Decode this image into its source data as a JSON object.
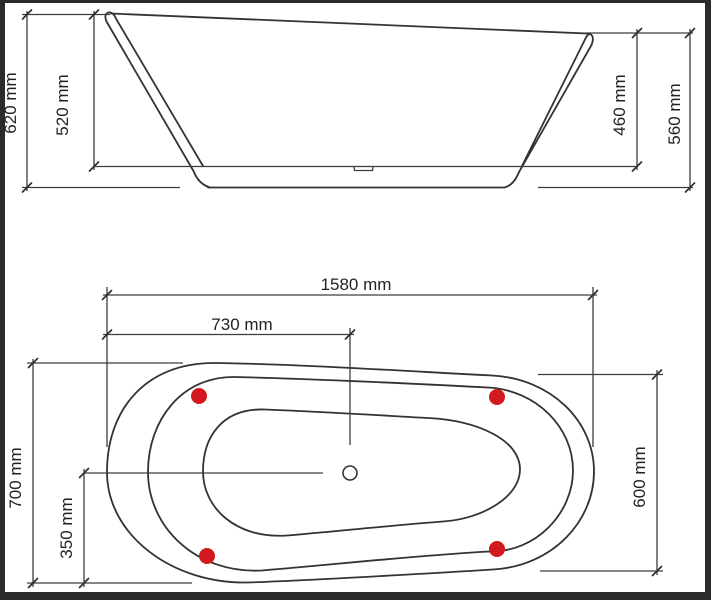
{
  "side_view": {
    "height_left_total": "620 mm",
    "height_left_inner": "520 mm",
    "height_right_inner": "460 mm",
    "height_right_total": "560 mm"
  },
  "plan_view": {
    "length_total": "1580 mm",
    "drain_from_left": "730 mm",
    "width_left_end": "700 mm",
    "width_half": "350 mm",
    "width_right_end": "600 mm"
  },
  "colors": {
    "line": "#333333",
    "dimension_line": "#3d3d3d",
    "foot_red": "#d2191f",
    "frame_border": "#2b2b2b",
    "background": "#ffffff"
  }
}
